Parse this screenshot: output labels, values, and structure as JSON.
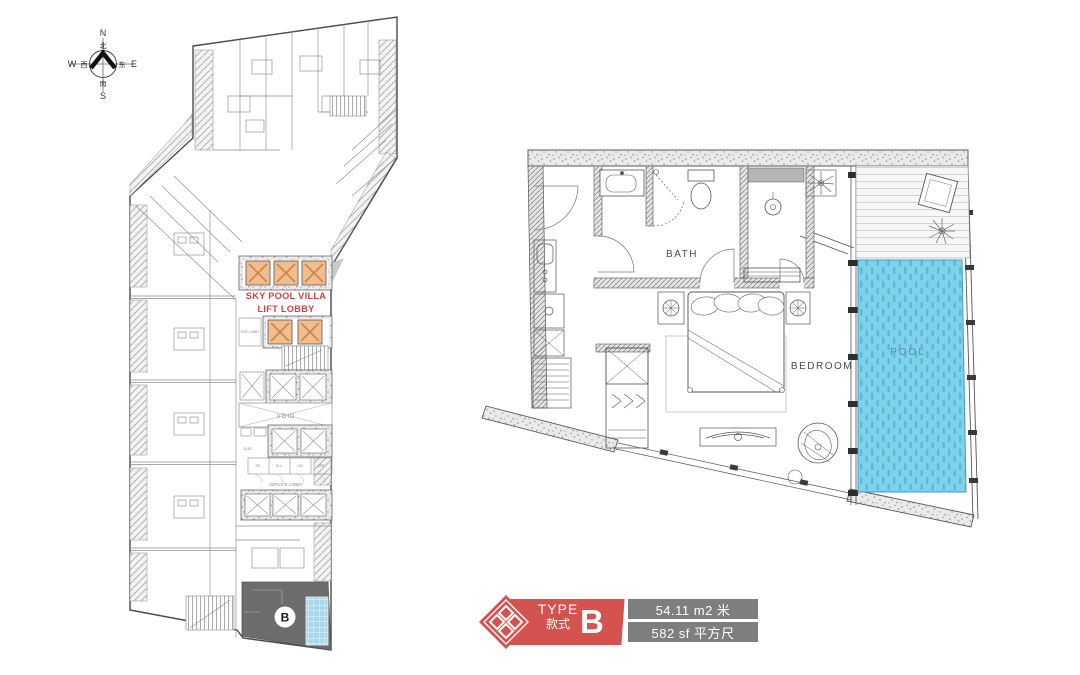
{
  "compass": {
    "north": "N",
    "south": "S",
    "east": "E",
    "west": "W",
    "north_cn": "北",
    "south_cn": "南",
    "east_cn": "东",
    "west_cn": "西"
  },
  "key_plan": {
    "highlight_line1": "SKY POOL VILLA",
    "highlight_line2": "LIFT LOBBY",
    "unit_marker": "B",
    "void_label": "VOID",
    "service_lobby_label": "SERVICE LOBBY",
    "fire_lobby_label": "FIRE LOBBY",
    "elec_label": "ELEC",
    "service_rooms": [
      "TEL",
      "ELV",
      "CW",
      "SPR"
    ],
    "colors": {
      "lift_fill": "#f2bd8c",
      "lift_cross": "#c9854f",
      "highlight_text": "#cf4440",
      "selected_unit_fill": "#6c6c6c",
      "selected_pool_fill": "#a9d8ea"
    }
  },
  "unit_plan": {
    "bath_label": "BATH",
    "bedroom_label": "BEDROOM",
    "pool_label": "POOL",
    "colors": {
      "pool_fill": "#7fd2ea",
      "pool_tile": "#55bcd8",
      "pool_text": "#6f8396"
    }
  },
  "badge": {
    "type_label": "TYPE",
    "type_label_cn": "款式",
    "type_letter": "B",
    "area_metric": "54.11 m2 米",
    "area_imperial": "582 sf  平方尺",
    "colors": {
      "red": "#d5534e",
      "gray": "#7e7e7e"
    }
  }
}
